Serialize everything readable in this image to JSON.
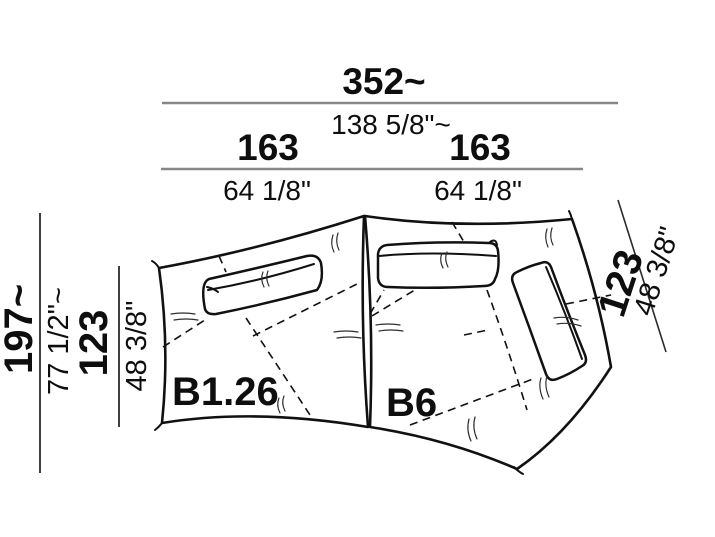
{
  "colors": {
    "ink": "#111111",
    "dimension_line_gray": "#878787",
    "dimension_line_dark": "#2b2b2b",
    "background": "#ffffff"
  },
  "labels": {
    "left_module": "B1.26",
    "right_module": "B6"
  },
  "dimensions": {
    "overall_width": {
      "cm": "352~",
      "inch": "138 5/8\"~"
    },
    "left_module_width": {
      "cm": "163",
      "inch": "64 1/8\""
    },
    "right_module_width": {
      "cm": "163",
      "inch": "64 1/8\""
    },
    "overall_depth": {
      "cm": "197~",
      "inch": "77 1/2\"~"
    },
    "left_module_depth": {
      "cm": "123",
      "inch": "48 3/8\""
    },
    "right_module_depth": {
      "cm": "123",
      "inch": "48 3/8\""
    }
  }
}
